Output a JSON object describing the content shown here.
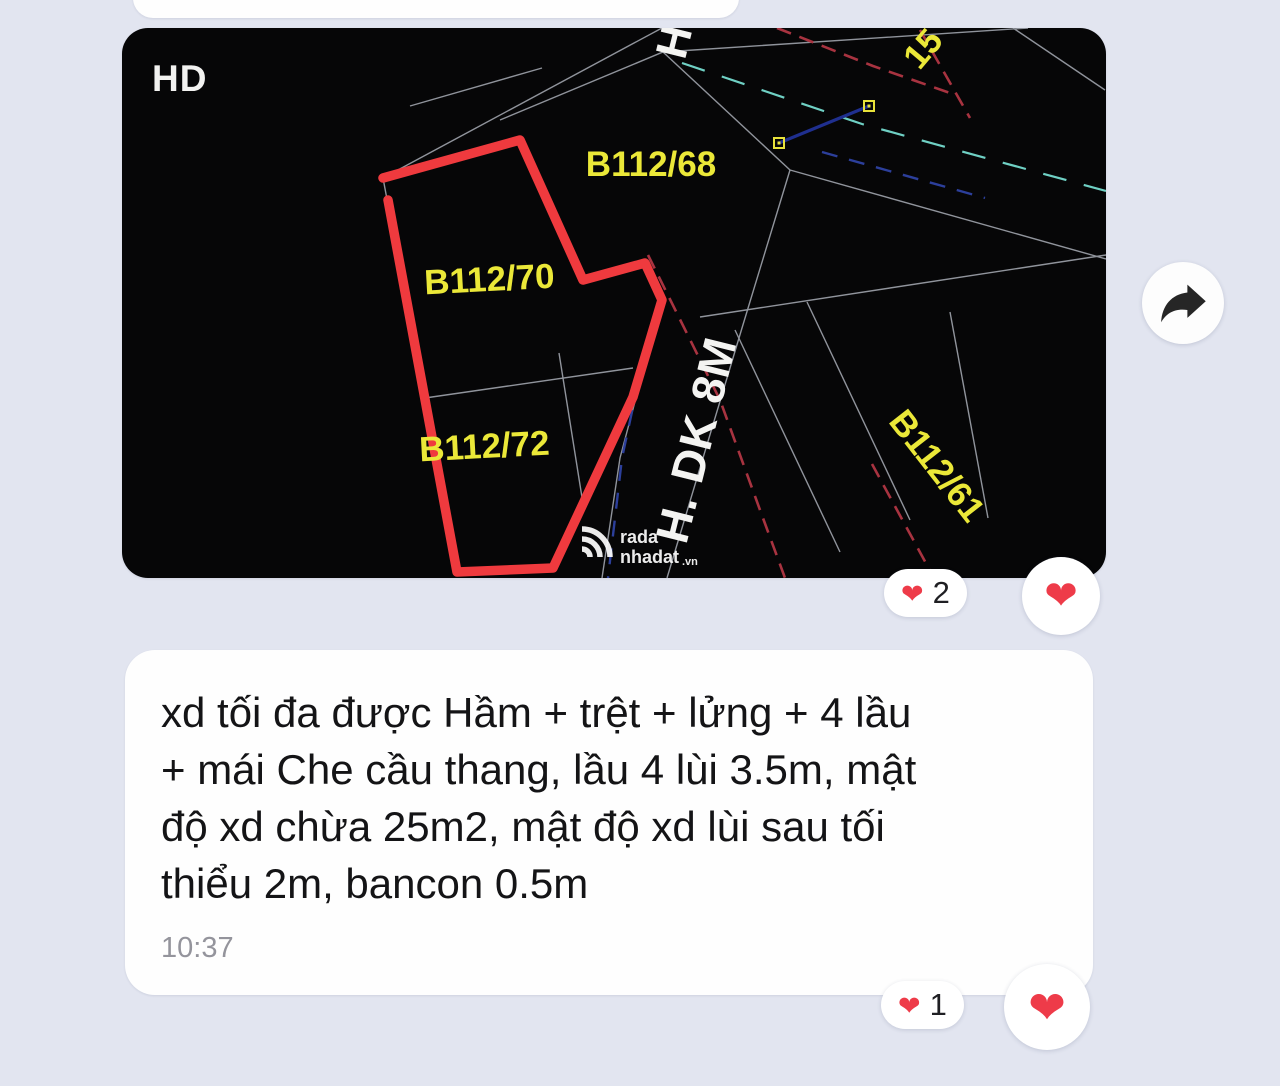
{
  "map_message": {
    "hd_label": "HD",
    "plots": {
      "p68": "B112/68",
      "p70": "B112/70",
      "p72": "B112/72",
      "p61": "B112/61",
      "p15_partial": "15"
    },
    "road_label": "H. DK 8M",
    "road_label_partial": "H",
    "watermark": {
      "word1": "rada",
      "word2": "nhadat",
      "suffix": ".vn"
    },
    "reaction": {
      "heart": "❤",
      "count": "2"
    },
    "quick_react_heart": "❤"
  },
  "share_button": {
    "icon": "forward-arrow"
  },
  "text_message": {
    "lines": [
      "xd tối đa được Hầm + trệt + lửng + 4 lầu",
      "+ mái Che cầu thang, lầu 4 lùi 3.5m, mật",
      "độ xd chừa 25m2, mật độ xd lùi sau tối",
      "thiểu 2m, bancon 0.5m"
    ],
    "time": "10:37",
    "reaction": {
      "heart": "❤",
      "count": "1"
    },
    "quick_react_heart": "❤"
  },
  "colors": {
    "background": "#e2e5f0",
    "plot_outline_red": "#ef3a3e",
    "parcel_label_yellow": "#ebe838",
    "reaction_heart": "#ee3b49"
  }
}
